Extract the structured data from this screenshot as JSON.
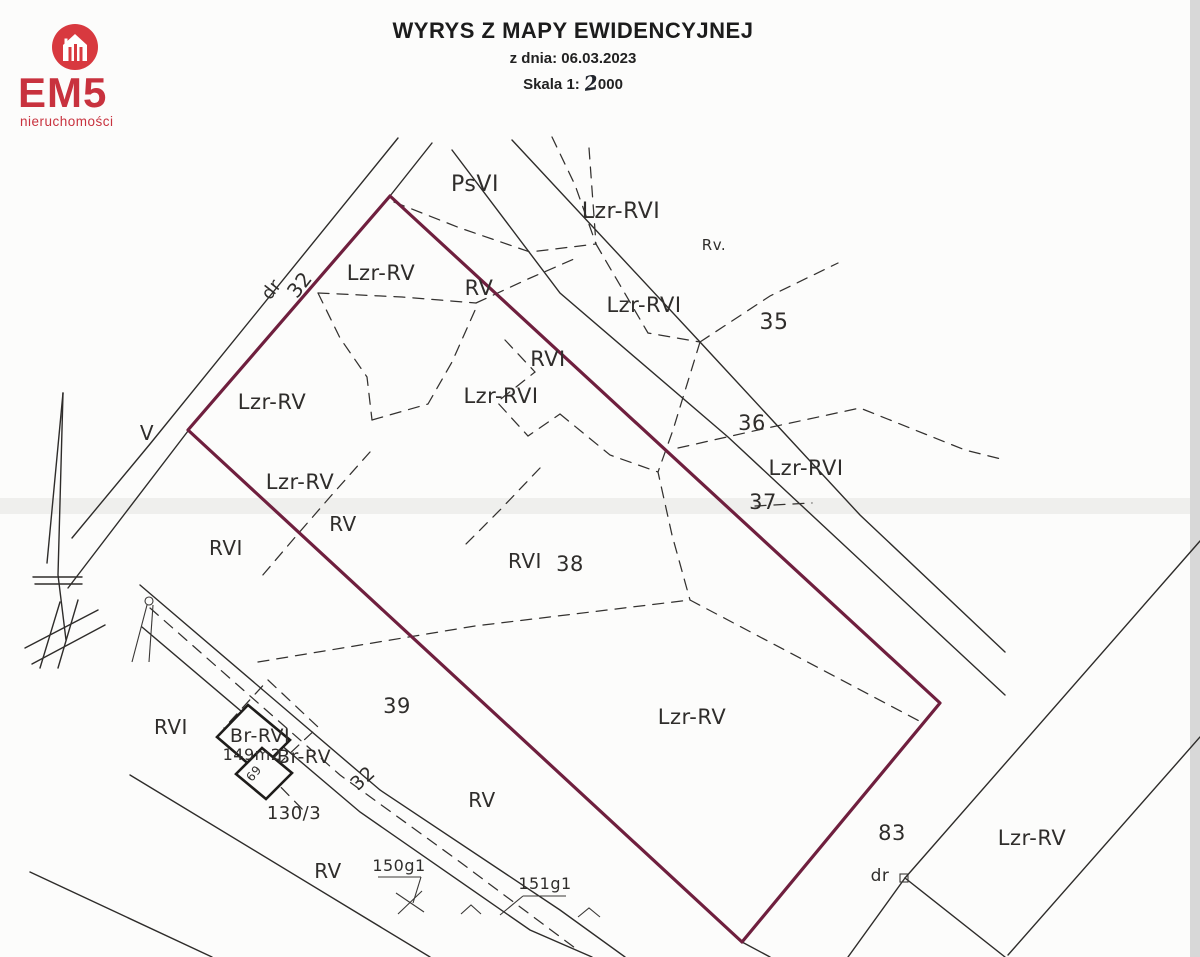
{
  "logo": {
    "brand": "EM5",
    "subtitle": "nieruchomości",
    "colors": {
      "circle": "#d8393f",
      "text": "#c8323e"
    }
  },
  "header": {
    "title": "WYRYS Z MAPY EWIDENCYJNEJ",
    "date_line": "z dnia: 06.03.2023",
    "scale_label": "Skala 1:",
    "scale_digit": "2",
    "scale_zeros": "000"
  },
  "map": {
    "colors": {
      "highlight_boundary": "#6f1f3e",
      "line": "#2e2c2a",
      "scan_band": "#ebebea",
      "scan_edge": "#d8d8d8"
    },
    "labels": [
      {
        "name": "psvi",
        "text": "PsVI",
        "x": 475,
        "y": 191,
        "s": 22,
        "r": 0
      },
      {
        "name": "lzr-rvi-top",
        "text": "Lzr-RVI",
        "x": 621,
        "y": 218,
        "s": 22,
        "r": 0
      },
      {
        "name": "rv-small",
        "text": "Rv.",
        "x": 714,
        "y": 250,
        "s": 15,
        "r": 0
      },
      {
        "name": "dr-top",
        "text": "dr",
        "x": 276,
        "y": 293,
        "s": 18,
        "r": -52
      },
      {
        "name": "32-top",
        "text": "32",
        "x": 305,
        "y": 289,
        "s": 20,
        "r": -52
      },
      {
        "name": "lzr-rv-1",
        "text": "Lzr-RV",
        "x": 381,
        "y": 280,
        "s": 21,
        "r": 0
      },
      {
        "name": "rv-1",
        "text": "RV",
        "x": 479,
        "y": 295,
        "s": 21,
        "r": 0
      },
      {
        "name": "lzr-rvi-2",
        "text": "Lzr-RVI",
        "x": 644,
        "y": 312,
        "s": 21,
        "r": 0
      },
      {
        "name": "35",
        "text": "35",
        "x": 774,
        "y": 329,
        "s": 22,
        "r": 0
      },
      {
        "name": "rvi-1",
        "text": "RVI",
        "x": 548,
        "y": 366,
        "s": 21,
        "r": 0
      },
      {
        "name": "lzr-rvi-3",
        "text": "Lzr-RVI",
        "x": 501,
        "y": 403,
        "s": 21,
        "r": 0
      },
      {
        "name": "lzr-rv-2",
        "text": "Lzr-RV",
        "x": 272,
        "y": 409,
        "s": 21,
        "r": 0
      },
      {
        "name": "v-edge",
        "text": "V",
        "x": 147,
        "y": 440,
        "s": 20,
        "r": 0
      },
      {
        "name": "36",
        "text": "36",
        "x": 752,
        "y": 430,
        "s": 21,
        "r": 0
      },
      {
        "name": "lzr-rvi-4",
        "text": "Lzr-RVI",
        "x": 806,
        "y": 475,
        "s": 21,
        "r": 0
      },
      {
        "name": "37",
        "text": "37",
        "x": 763,
        "y": 509,
        "s": 21,
        "r": 0
      },
      {
        "name": "lzr-rv-3",
        "text": "Lzr-RV",
        "x": 300,
        "y": 489,
        "s": 21,
        "r": 0
      },
      {
        "name": "rv-2",
        "text": "RV",
        "x": 343,
        "y": 531,
        "s": 20,
        "r": 0
      },
      {
        "name": "rvi-2",
        "text": "RVI",
        "x": 226,
        "y": 555,
        "s": 20,
        "r": 0
      },
      {
        "name": "rvi-3",
        "text": "RVI",
        "x": 525,
        "y": 568,
        "s": 20,
        "r": 0
      },
      {
        "name": "38",
        "text": "38",
        "x": 570,
        "y": 571,
        "s": 21,
        "r": 0
      },
      {
        "name": "rvi-4",
        "text": "RVI",
        "x": 171,
        "y": 734,
        "s": 20,
        "r": 0
      },
      {
        "name": "br-rvi",
        "text": "Br-RVI",
        "x": 260,
        "y": 742,
        "s": 19,
        "r": 0
      },
      {
        "name": "area-149m2",
        "text": "149m2",
        "x": 252,
        "y": 760,
        "s": 16,
        "r": 0
      },
      {
        "name": "69",
        "text": "69",
        "x": 257,
        "y": 776,
        "s": 12,
        "r": -50
      },
      {
        "name": "br-rv",
        "text": "Br-RV",
        "x": 304,
        "y": 763,
        "s": 19,
        "r": 0
      },
      {
        "name": "39",
        "text": "39",
        "x": 397,
        "y": 713,
        "s": 21,
        "r": 0
      },
      {
        "name": "32-bottom",
        "text": "32",
        "x": 367,
        "y": 783,
        "s": 19,
        "r": -42
      },
      {
        "name": "130-3",
        "text": "130/3",
        "x": 294,
        "y": 819,
        "s": 18,
        "r": 0
      },
      {
        "name": "rv-3",
        "text": "RV",
        "x": 482,
        "y": 807,
        "s": 20,
        "r": 0
      },
      {
        "name": "lzr-rv-4",
        "text": "Lzr-RV",
        "x": 692,
        "y": 724,
        "s": 21,
        "r": 0
      },
      {
        "name": "83",
        "text": "83",
        "x": 892,
        "y": 840,
        "s": 21,
        "r": 0
      },
      {
        "name": "dr-bottom",
        "text": "dr",
        "x": 880,
        "y": 881,
        "s": 17,
        "r": 0
      },
      {
        "name": "lzr-rv-5",
        "text": "Lzr-RV",
        "x": 1032,
        "y": 845,
        "s": 21,
        "r": 0
      },
      {
        "name": "rv-4",
        "text": "RV",
        "x": 328,
        "y": 878,
        "s": 20,
        "r": 0
      },
      {
        "name": "150g1",
        "text": "150g1",
        "x": 399,
        "y": 871,
        "s": 16,
        "r": 0
      },
      {
        "name": "151g1",
        "text": "151g1",
        "x": 545,
        "y": 889,
        "s": 16,
        "r": 0
      }
    ]
  }
}
